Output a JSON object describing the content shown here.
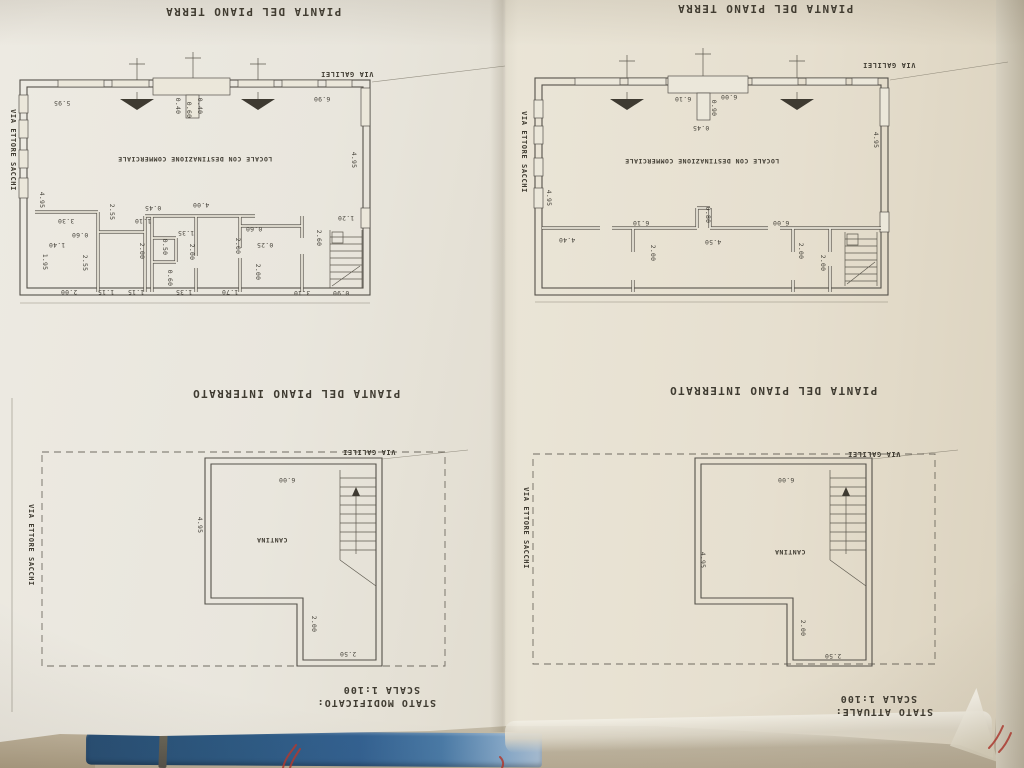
{
  "captions": {
    "ground_floor": "PIANTA DEL PIANO TERRA",
    "basement": "PIANTA DEL PIANO INTERRATO",
    "status_left": "STATO MODIFICATO:",
    "status_right": "STATO ATTUALE:",
    "scale": "SCALA 1:100"
  },
  "streets": {
    "galilei": "VIA GALILEI",
    "sacchi": "VIA ETTORE SACCHI"
  },
  "room_labels": {
    "commercial": "LOCALE CON DESTINAZIONE COMMERCIALE",
    "cellar": "CANTINA"
  },
  "colors": {
    "paper": "#e9e6dd",
    "ink": "#55514a",
    "binder_blue": "#2d5a84",
    "marker_red": "#b23a30"
  },
  "plans": {
    "left_ground": {
      "labels": [
        {
          "t": "VIA GALILEI",
          "x": 347,
          "y": 72,
          "o": "h",
          "k": "street"
        },
        {
          "t": "VIA ETTORE SACCHI",
          "x": 11,
          "y": 150,
          "o": "v",
          "k": "street"
        },
        {
          "t": "LOCALE CON DESTINAZIONE COMMERCIALE",
          "x": 195,
          "y": 157,
          "o": "h",
          "k": "room"
        },
        {
          "t": "5.95",
          "x": 62,
          "y": 101,
          "o": "h",
          "k": "dim"
        },
        {
          "t": "6.90",
          "x": 322,
          "y": 97,
          "o": "h",
          "k": "dim"
        },
        {
          "t": "0.40",
          "x": 176,
          "y": 106,
          "o": "v",
          "k": "dim"
        },
        {
          "t": "0.60",
          "x": 187,
          "y": 110,
          "o": "v",
          "k": "dim"
        },
        {
          "t": "0.40",
          "x": 198,
          "y": 106,
          "o": "v",
          "k": "dim"
        },
        {
          "t": "4.95",
          "x": 352,
          "y": 160,
          "o": "v",
          "k": "dim"
        },
        {
          "t": "4.95",
          "x": 40,
          "y": 200,
          "o": "v",
          "k": "dim"
        },
        {
          "t": "1.20",
          "x": 346,
          "y": 216,
          "o": "h",
          "k": "dim"
        },
        {
          "t": "2.60",
          "x": 317,
          "y": 238,
          "o": "v",
          "k": "dim"
        },
        {
          "t": "0.90",
          "x": 341,
          "y": 291,
          "o": "h",
          "k": "dim"
        },
        {
          "t": "3.10",
          "x": 302,
          "y": 291,
          "o": "h",
          "k": "dim"
        },
        {
          "t": "3.30",
          "x": 66,
          "y": 219,
          "o": "h",
          "k": "dim"
        },
        {
          "t": "0.60",
          "x": 80,
          "y": 233,
          "o": "h",
          "k": "dim"
        },
        {
          "t": "1.40",
          "x": 57,
          "y": 243,
          "o": "h",
          "k": "dim"
        },
        {
          "t": "1.95",
          "x": 43,
          "y": 262,
          "o": "v",
          "k": "dim"
        },
        {
          "t": "2.55",
          "x": 110,
          "y": 212,
          "o": "v",
          "k": "dim"
        },
        {
          "t": "2.55",
          "x": 83,
          "y": 263,
          "o": "v",
          "k": "dim"
        },
        {
          "t": "2.00",
          "x": 69,
          "y": 290,
          "o": "h",
          "k": "dim"
        },
        {
          "t": "1.15",
          "x": 106,
          "y": 290,
          "o": "h",
          "k": "dim"
        },
        {
          "t": "1.15",
          "x": 136,
          "y": 290,
          "o": "h",
          "k": "dim"
        },
        {
          "t": "0.45",
          "x": 153,
          "y": 206,
          "o": "h",
          "k": "dim"
        },
        {
          "t": "4.00",
          "x": 201,
          "y": 203,
          "o": "h",
          "k": "dim"
        },
        {
          "t": "1.10",
          "x": 143,
          "y": 219,
          "o": "h",
          "k": "dim"
        },
        {
          "t": "2.00",
          "x": 140,
          "y": 251,
          "o": "v",
          "k": "dim"
        },
        {
          "t": "0.50",
          "x": 163,
          "y": 247,
          "o": "v",
          "k": "dim"
        },
        {
          "t": "0.60",
          "x": 168,
          "y": 278,
          "o": "v",
          "k": "dim"
        },
        {
          "t": "1.35",
          "x": 186,
          "y": 231,
          "o": "h",
          "k": "dim"
        },
        {
          "t": "1.35",
          "x": 184,
          "y": 290,
          "o": "h",
          "k": "dim"
        },
        {
          "t": "2.00",
          "x": 190,
          "y": 252,
          "o": "v",
          "k": "dim"
        },
        {
          "t": "0.60",
          "x": 254,
          "y": 227,
          "o": "h",
          "k": "dim"
        },
        {
          "t": "0.25",
          "x": 265,
          "y": 243,
          "o": "h",
          "k": "dim"
        },
        {
          "t": "2.00",
          "x": 236,
          "y": 246,
          "o": "v",
          "k": "dim"
        },
        {
          "t": "1.70",
          "x": 230,
          "y": 290,
          "o": "h",
          "k": "dim"
        },
        {
          "t": "2.00",
          "x": 256,
          "y": 272,
          "o": "v",
          "k": "dim"
        }
      ]
    },
    "right_ground": {
      "labels": [
        {
          "t": "VIA GALILEI",
          "x": 889,
          "y": 63,
          "o": "h",
          "k": "street"
        },
        {
          "t": "VIA ETTORE SACCHI",
          "x": 522,
          "y": 152,
          "o": "v",
          "k": "street"
        },
        {
          "t": "LOCALE CON DESTINAZIONE COMMERCIALE",
          "x": 702,
          "y": 159,
          "o": "h",
          "k": "room"
        },
        {
          "t": "6.10",
          "x": 683,
          "y": 97,
          "o": "h",
          "k": "dim"
        },
        {
          "t": "6.00",
          "x": 729,
          "y": 95,
          "o": "h",
          "k": "dim"
        },
        {
          "t": "0.90",
          "x": 712,
          "y": 108,
          "o": "v",
          "k": "dim"
        },
        {
          "t": "0.45",
          "x": 701,
          "y": 126,
          "o": "h",
          "k": "dim"
        },
        {
          "t": "4.95",
          "x": 874,
          "y": 140,
          "o": "v",
          "k": "dim"
        },
        {
          "t": "4.95",
          "x": 547,
          "y": 198,
          "o": "v",
          "k": "dim"
        },
        {
          "t": "6.10",
          "x": 641,
          "y": 221,
          "o": "h",
          "k": "dim"
        },
        {
          "t": "0.80",
          "x": 706,
          "y": 215,
          "o": "v",
          "k": "dim"
        },
        {
          "t": "6.00",
          "x": 781,
          "y": 221,
          "o": "h",
          "k": "dim"
        },
        {
          "t": "4.50",
          "x": 713,
          "y": 240,
          "o": "h",
          "k": "dim"
        },
        {
          "t": "4.40",
          "x": 567,
          "y": 238,
          "o": "h",
          "k": "dim"
        },
        {
          "t": "2.00",
          "x": 651,
          "y": 253,
          "o": "v",
          "k": "dim"
        },
        {
          "t": "2.00",
          "x": 799,
          "y": 251,
          "o": "v",
          "k": "dim"
        },
        {
          "t": "2.00",
          "x": 821,
          "y": 263,
          "o": "v",
          "k": "dim"
        }
      ]
    },
    "left_basement": {
      "labels": [
        {
          "t": "VIA GALILEI",
          "x": 369,
          "y": 450,
          "o": "h",
          "k": "street"
        },
        {
          "t": "VIA ETTORE SACCHI",
          "x": 29,
          "y": 545,
          "o": "v",
          "k": "street"
        },
        {
          "t": "CANTINA",
          "x": 272,
          "y": 538,
          "o": "h",
          "k": "room"
        },
        {
          "t": "6.00",
          "x": 287,
          "y": 478,
          "o": "h",
          "k": "dim"
        },
        {
          "t": "4.95",
          "x": 198,
          "y": 525,
          "o": "v",
          "k": "dim"
        },
        {
          "t": "2.00",
          "x": 312,
          "y": 624,
          "o": "v",
          "k": "dim"
        },
        {
          "t": "2.50",
          "x": 348,
          "y": 652,
          "o": "h",
          "k": "dim"
        }
      ]
    },
    "right_basement": {
      "labels": [
        {
          "t": "VIA GALILEI",
          "x": 874,
          "y": 452,
          "o": "h",
          "k": "street"
        },
        {
          "t": "VIA ETTORE SACCHI",
          "x": 524,
          "y": 528,
          "o": "v",
          "k": "street"
        },
        {
          "t": "CANTINA",
          "x": 790,
          "y": 550,
          "o": "h",
          "k": "room"
        },
        {
          "t": "6.00",
          "x": 786,
          "y": 478,
          "o": "h",
          "k": "dim"
        },
        {
          "t": "4.95",
          "x": 701,
          "y": 560,
          "o": "v",
          "k": "dim"
        },
        {
          "t": "2.00",
          "x": 801,
          "y": 628,
          "o": "v",
          "k": "dim"
        },
        {
          "t": "2.50",
          "x": 833,
          "y": 654,
          "o": "h",
          "k": "dim"
        }
      ]
    }
  }
}
